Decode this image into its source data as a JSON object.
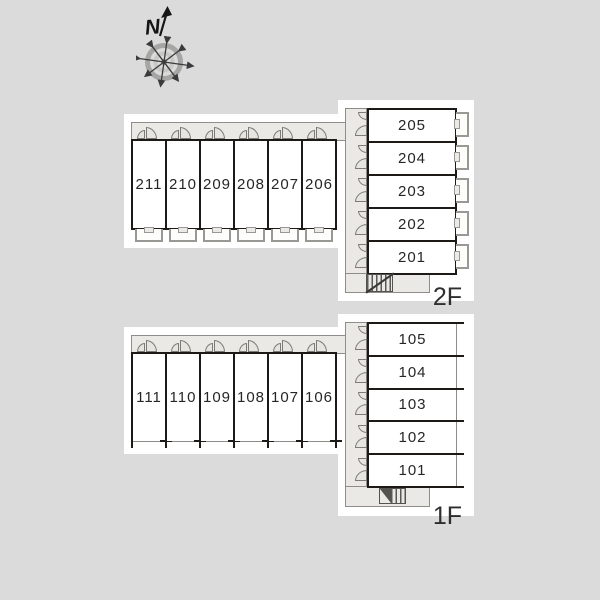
{
  "compass": {
    "north_label": "N"
  },
  "floors": [
    {
      "label": "2F",
      "row_rooms": [
        "211",
        "210",
        "209",
        "208",
        "207",
        "206"
      ],
      "col_rooms": [
        "205",
        "204",
        "203",
        "202",
        "201"
      ]
    },
    {
      "label": "1F",
      "row_rooms": [
        "111",
        "110",
        "109",
        "108",
        "107",
        "106"
      ],
      "col_rooms": [
        "105",
        "104",
        "103",
        "102",
        "101"
      ]
    }
  ],
  "colors": {
    "background": "#dbdbdb",
    "wall": "#1c1917",
    "corridor": "#eae9e5",
    "outline_gray": "#8f8d89",
    "room_fill": "#ffffff"
  }
}
